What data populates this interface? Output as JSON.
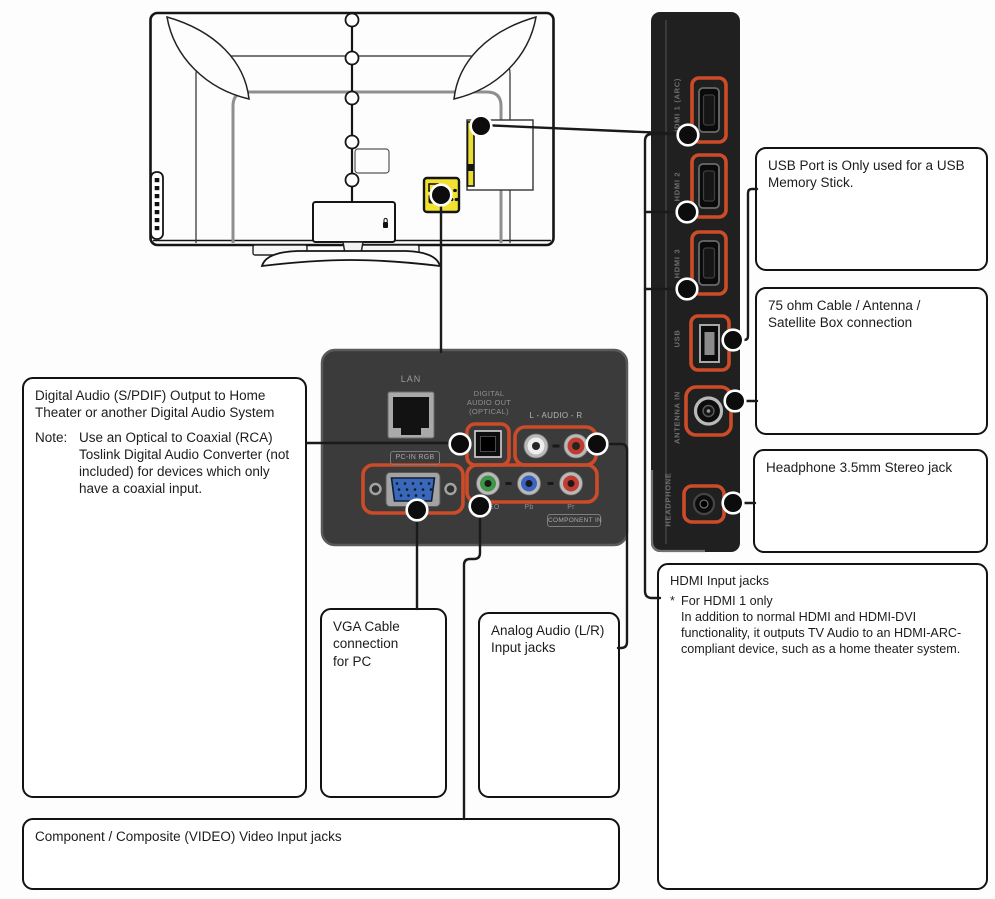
{
  "side_panel": {
    "port_labels": {
      "hdmi1": "HDMI 1 (ARC)",
      "hdmi2": "HDMI 2",
      "hdmi3": "HDMI 3",
      "usb": "USB",
      "antenna": "ANTENNA IN",
      "headphone": "HEADPHONE"
    }
  },
  "rear_panel": {
    "lan": "LAN",
    "digital_audio_out_lines": [
      "DIGITAL",
      "AUDIO OUT",
      "(OPTICAL)"
    ],
    "audio_lr": "L - AUDIO - R",
    "pc_in_rgb": "PC-IN RGB",
    "video": "VIDEO",
    "pb": "Pb",
    "pr": "Pr",
    "component_in": "COMPONENT IN"
  },
  "callouts": {
    "usb": "USB Port is Only used for a USB\nMemory Stick.",
    "antenna": "75 ohm Cable / Antenna /\nSatellite Box connection",
    "headphone": "Headphone 3.5mm Stereo jack",
    "hdmi": {
      "title": "HDMI Input jacks",
      "note_marker": "*",
      "note_title": "For HDMI 1 only",
      "note_body": "In addition to normal HDMI and HDMI-DVI\nfunctionality, it outputs TV Audio to an HDMI-ARC-\ncompliant device, such as a home theater system."
    },
    "digital_audio": {
      "title": "Digital Audio (S/PDIF) Output to Home\nTheater or another Digital Audio System",
      "note_label": "Note:",
      "note_body": "Use an Optical to Coaxial (RCA)\nToslink Digital Audio Converter (not\nincluded) for devices which only\nhave a coaxial input."
    },
    "vga": "VGA Cable\nconnection\nfor PC",
    "analog_audio": "Analog Audio (L/R)\nInput jacks",
    "component": "Component / Composite (VIDEO) Video Input jacks"
  },
  "colors": {
    "highlight_outline": "#cc4b28",
    "label_yellow": "#f2e12f",
    "side_strip_black": "#202020",
    "rear_panel_gray": "#3b3b3b"
  }
}
